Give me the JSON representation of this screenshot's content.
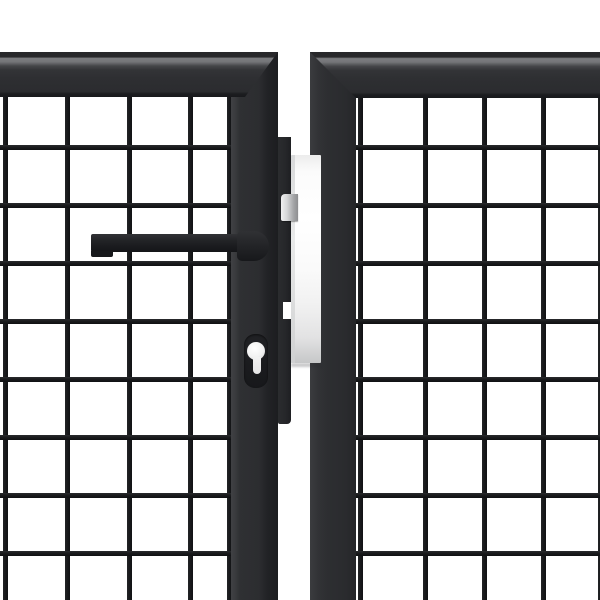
{
  "scene": {
    "description": "Close-up 3D product render of a double garden gate: two anthracite steel leaves with square wire mesh infill meeting in the middle, fitted with a lever handle, a euro-profile keyhole and a white lock keep plate between the leaves on a white background",
    "background_color": "#ffffff",
    "colors": {
      "background": "#ffffff",
      "frame": "#2d2e31",
      "frame_highlight": "#7c7d80",
      "mesh_wire": "#1b1c1e",
      "hardware": "#1d1e21",
      "lock_bar": "#26272a",
      "lock_plate": "#f7f7f7",
      "latch": "#b9babc",
      "keyhole_face": "#f2f2f2"
    },
    "left_leaf": {
      "name": "left-gate-leaf",
      "finish": "anthracite",
      "mesh": {
        "wire_thickness_px": 5,
        "vertical_wires_x": [
          3,
          65,
          127,
          188,
          227
        ],
        "horizontal_wires_y": [
          48,
          106,
          164,
          222,
          280,
          338,
          396,
          454
        ]
      }
    },
    "right_leaf": {
      "name": "right-gate-leaf",
      "finish": "anthracite",
      "mesh": {
        "wire_thickness_px": 5,
        "vertical_wires_x": [
          2,
          67,
          126,
          185,
          242
        ],
        "horizontal_wires_y": [
          47,
          105,
          163,
          221,
          279,
          337,
          395,
          453
        ]
      }
    },
    "hardware": {
      "handle": "lever-handle",
      "keyhole": "euro-cylinder-keyhole",
      "lock_plate": "lock-keep-plate",
      "latch": "latch-bolt"
    }
  }
}
